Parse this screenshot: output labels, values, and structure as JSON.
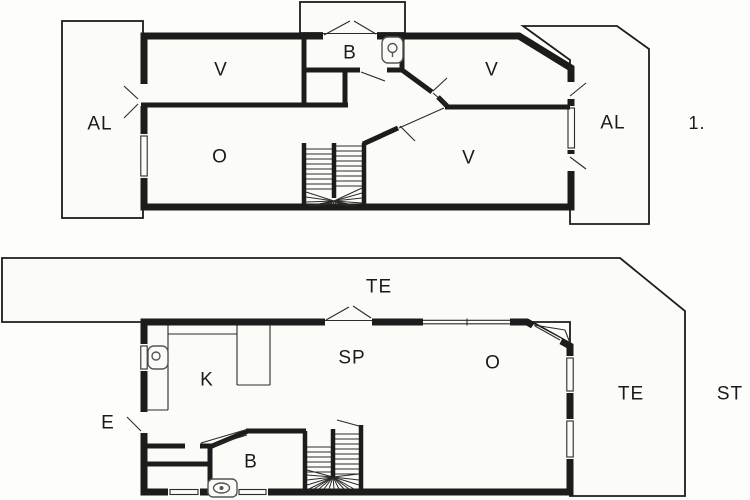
{
  "drawing_title": "Two-storey house floor plan",
  "colors": {
    "wall": "#1c1c1c",
    "thin_line": "#2b2b2b",
    "paper": "#fbfbf7",
    "background": "#fdfdfb"
  },
  "plans": {
    "upper": {
      "indicator": "1.",
      "rooms": {
        "balcony_left": "AL",
        "bedroom_nw": "V",
        "bathroom": "B",
        "bedroom_ne": "V",
        "balcony_right": "AL",
        "living": "O",
        "bedroom_se": "V"
      }
    },
    "ground": {
      "indicator": "ST",
      "rooms": {
        "terrace_top": "TE",
        "kitchen": "K",
        "dining": "SP",
        "living": "O",
        "terrace_right": "TE",
        "entrance": "E",
        "bathroom": "B"
      }
    }
  },
  "icons": {
    "upper_bathroom_fixture": "toilet-icon",
    "ground_bathroom_fixture": "toilet-icon",
    "kitchen_fixture": "sink-icon",
    "stairs_upper": "staircase-icon",
    "stairs_ground": "staircase-icon"
  }
}
